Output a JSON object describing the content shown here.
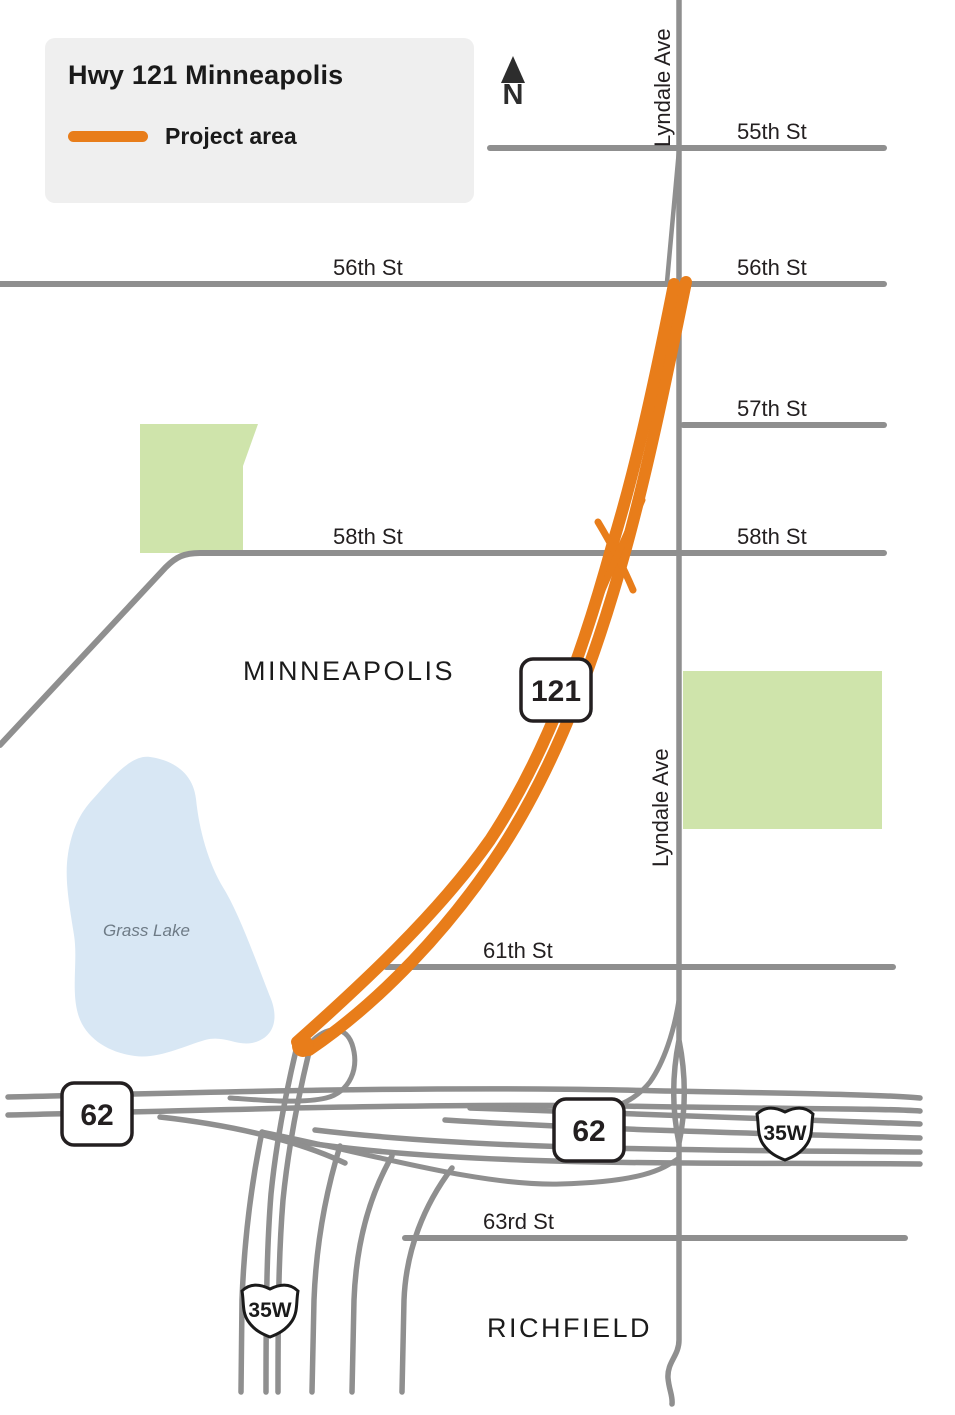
{
  "legend": {
    "title": "Hwy 121 Minneapolis",
    "project_area_label": "Project area"
  },
  "north_arrow": {
    "label": "N"
  },
  "streets": {
    "s55": "55th St",
    "s56_left": "56th St",
    "s56_right": "56th St",
    "s57": "57th St",
    "s58_left": "58th St",
    "s58_right": "58th St",
    "s61": "61th St",
    "s63": "63rd St",
    "lyndale_top": "Lyndale Ave",
    "lyndale_mid": "Lyndale Ave"
  },
  "cities": {
    "minneapolis": "MINNEAPOLIS",
    "richfield": "RICHFIELD"
  },
  "water": {
    "grass_lake": "Grass Lake"
  },
  "shields": {
    "hwy121": "121",
    "hwy62_west": "62",
    "hwy62_center": "62",
    "i35w_east": "35W",
    "i35w_south": "35W"
  },
  "colors": {
    "project_orange": "#e87d1a",
    "road_gray": "#8f8f8f",
    "park_green": "#cfe4ab",
    "lake_blue": "#d8e7f4",
    "legend_bg": "#efefef",
    "label_dark": "#231f20"
  }
}
